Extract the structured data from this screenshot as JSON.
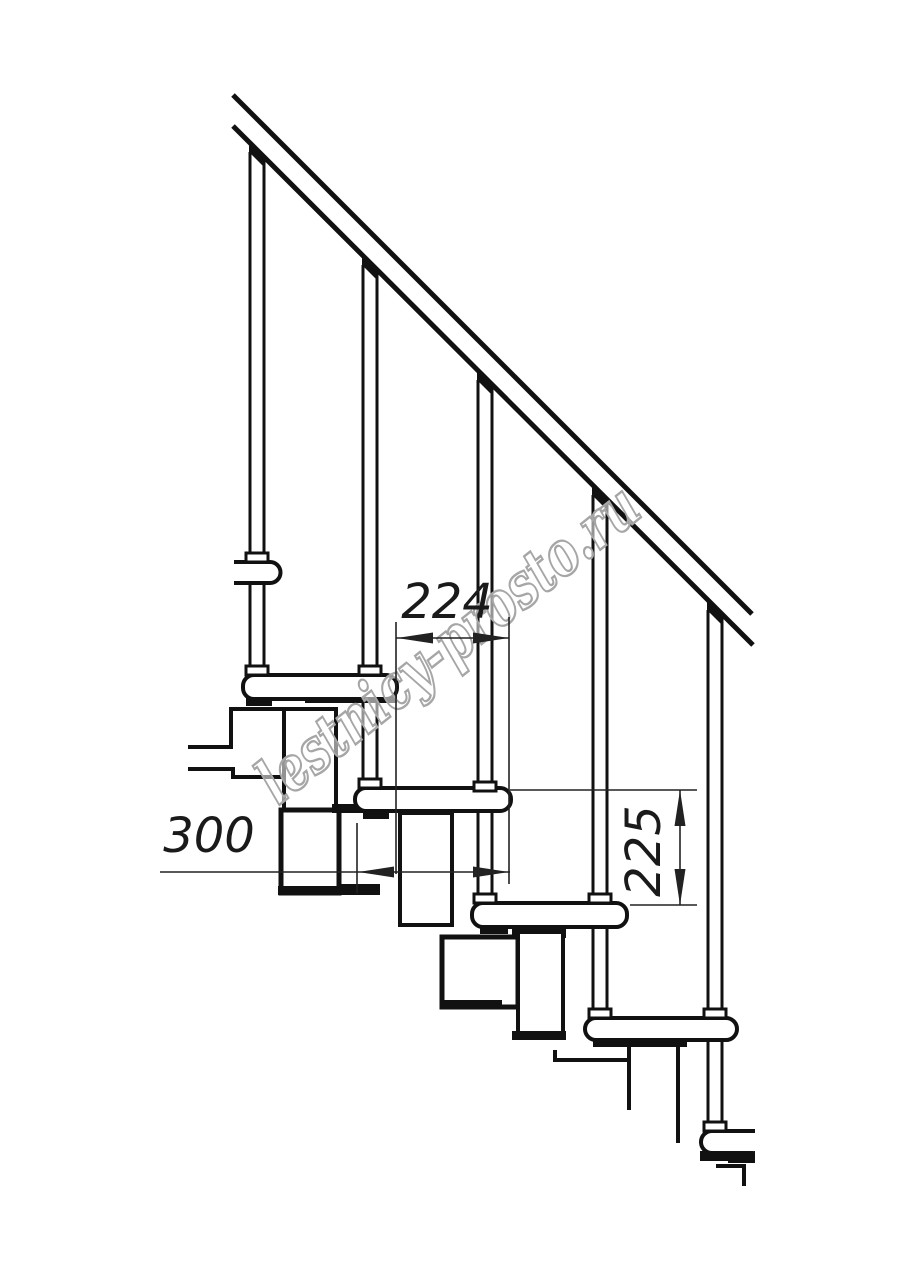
{
  "page": {
    "background": "#ffffff",
    "ink": "#111111",
    "dimension_color": "#222222"
  },
  "drawing": {
    "type": "technical-drawing",
    "subject": "modular staircase side view with handrail",
    "treads_visible": 6,
    "balusters_visible": 5,
    "handrail_angle_deg": 45
  },
  "dimensions": [
    {
      "label": "224",
      "orientation": "horizontal"
    },
    {
      "label": "300",
      "orientation": "horizontal"
    },
    {
      "label": "225",
      "orientation": "vertical"
    }
  ],
  "watermark": {
    "text": "lestnicy-prosto.ru",
    "color": "#a6a6a6"
  }
}
